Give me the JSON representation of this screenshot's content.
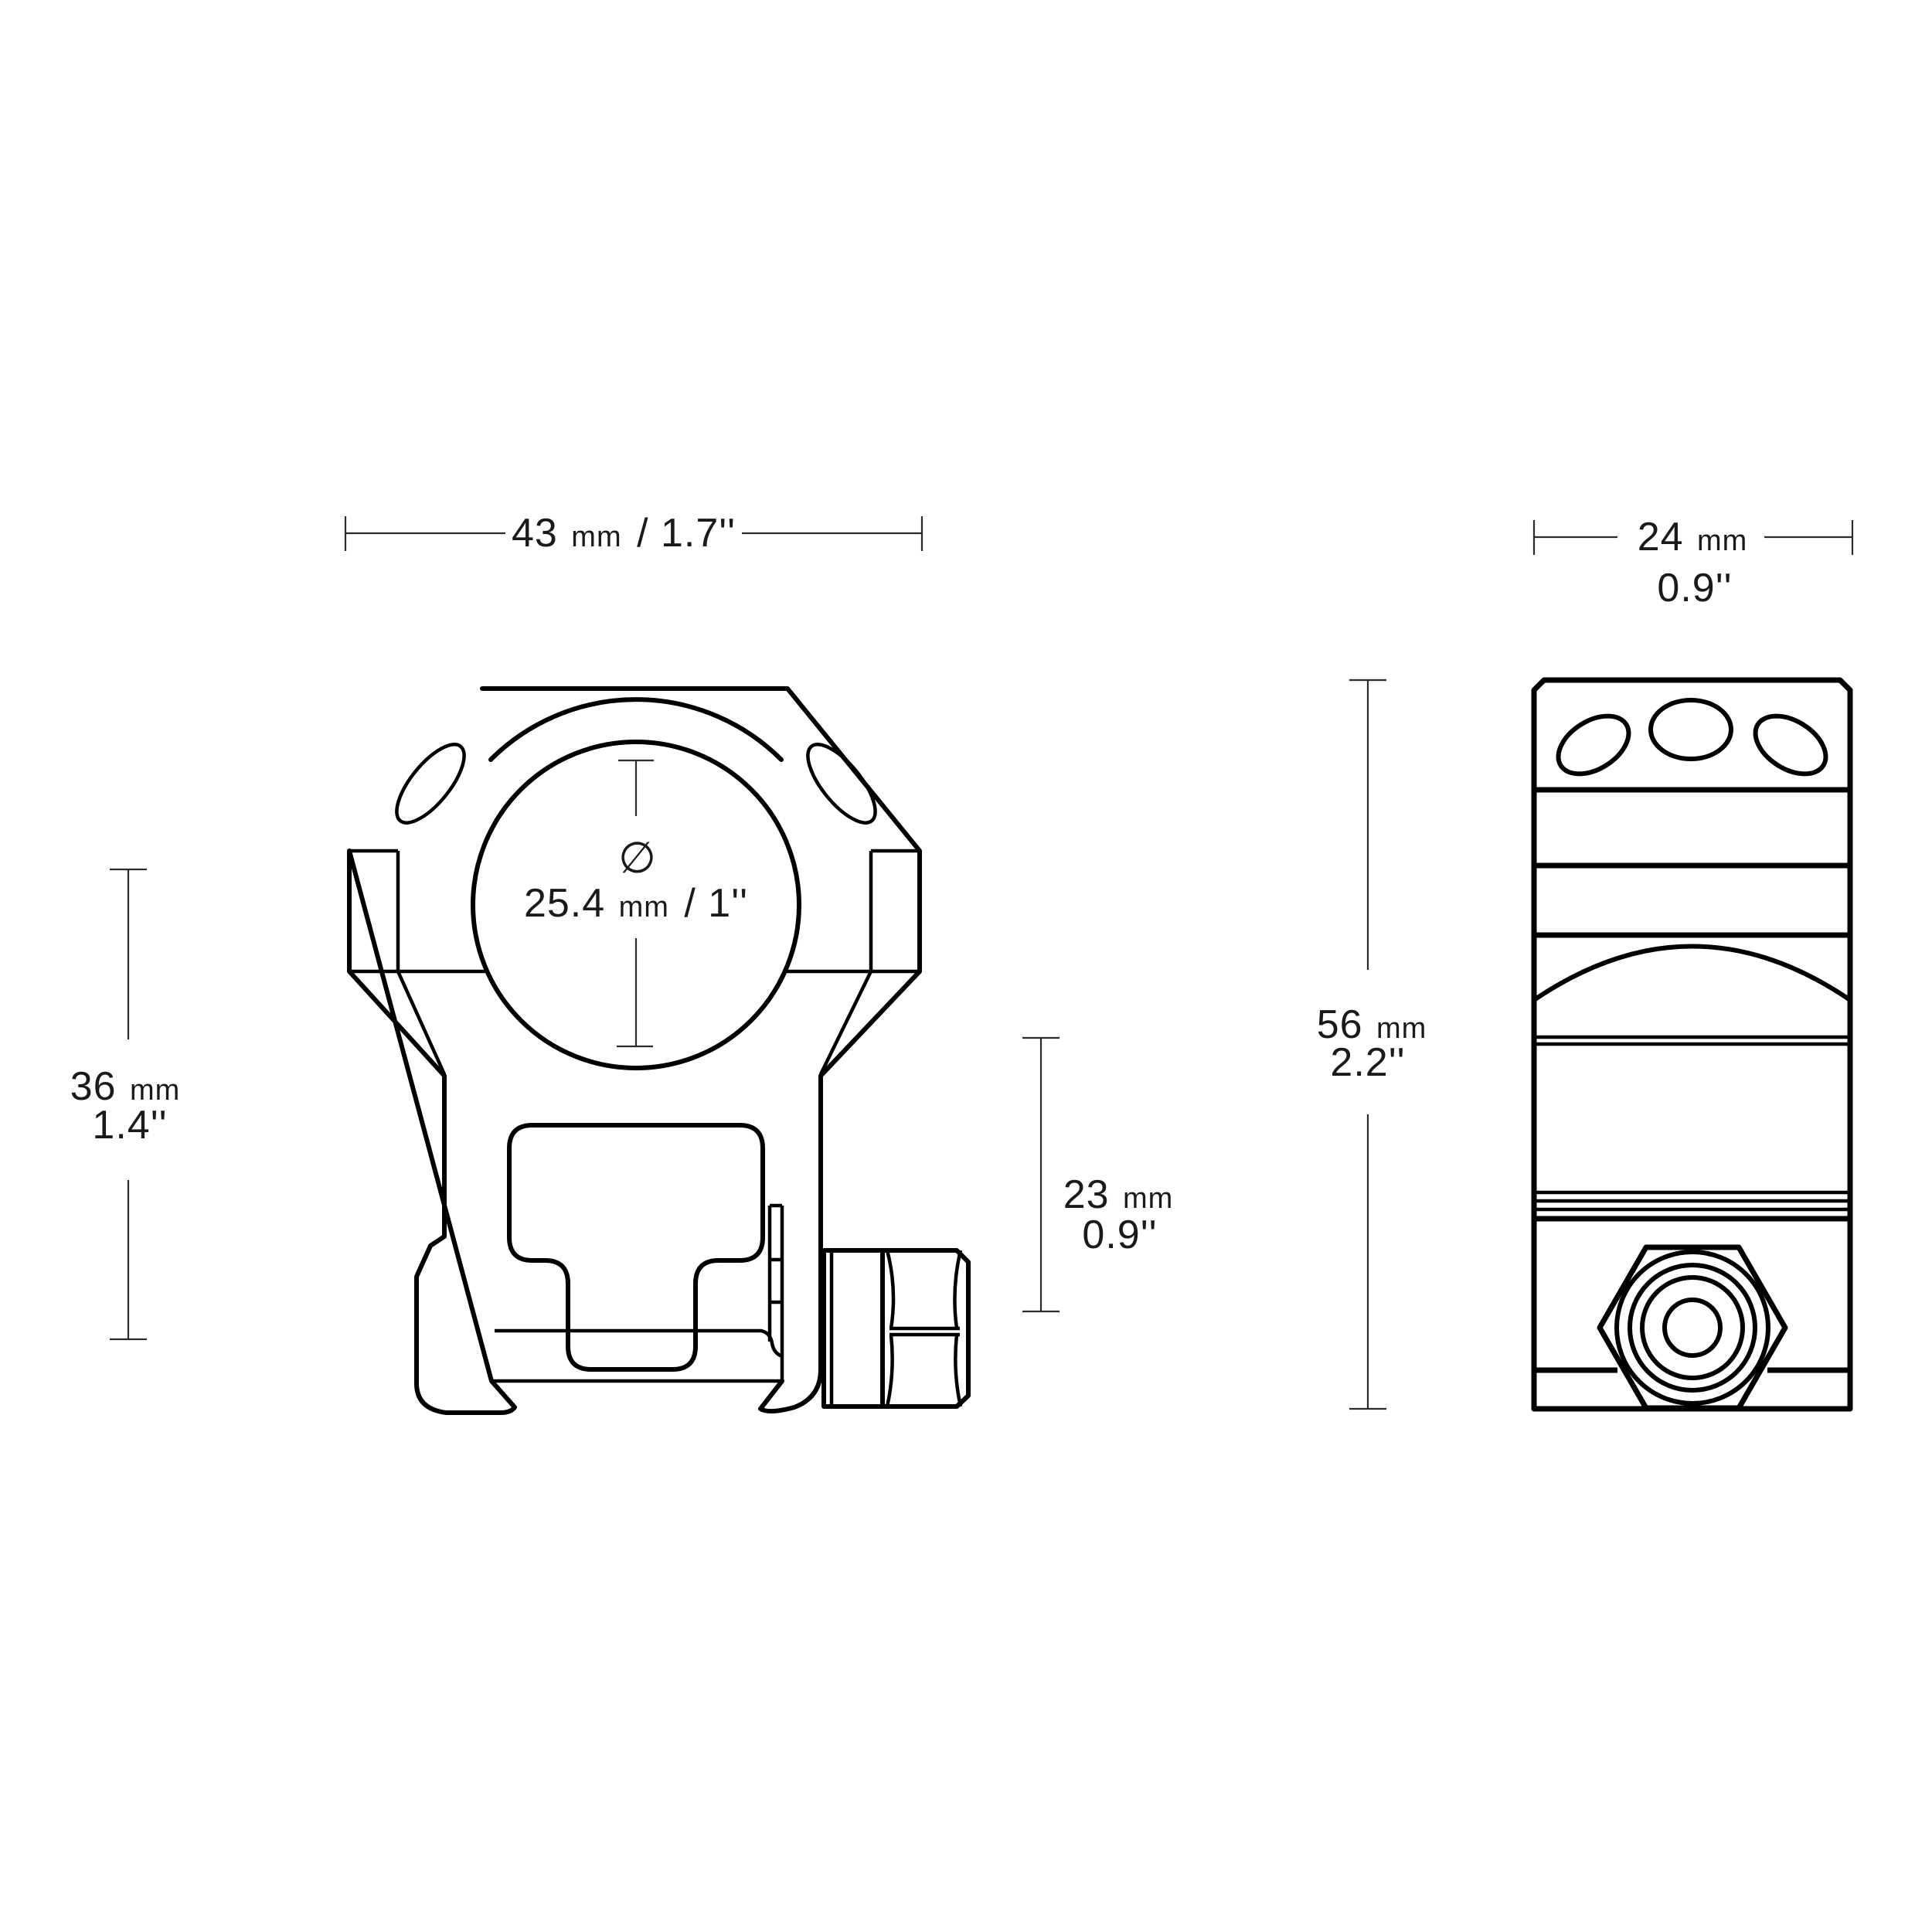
{
  "drawing": {
    "description": "scope ring mount technical drawing, front and side views",
    "colors": {
      "outline": "#000000",
      "dimension_line": "#2b2b2b",
      "text": "#1a1a1a",
      "background": "#ffffff"
    },
    "dims": {
      "front_width": {
        "num": "43",
        "unit": "mm",
        "inches_inline": "/ 1.7''"
      },
      "tube_diameter": {
        "symbol": "∅",
        "num": "25.4",
        "unit": "mm",
        "inches_inline": "/ 1''"
      },
      "front_height": {
        "num": "36",
        "unit": "mm",
        "inches": "1.4''"
      },
      "base_height": {
        "num": "23",
        "unit": "mm",
        "inches": "0.9''"
      },
      "side_width": {
        "num": "24",
        "unit": "mm",
        "inches": "0.9''"
      },
      "side_height": {
        "num": "56",
        "unit": "mm",
        "inches": "2.2''"
      }
    }
  }
}
